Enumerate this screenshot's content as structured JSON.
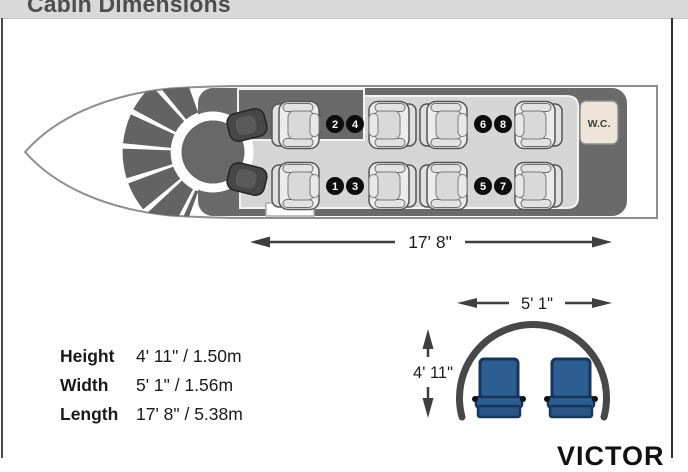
{
  "header": {
    "title": "Cabin Dimensions"
  },
  "plan": {
    "wc_label": "W.C.",
    "length_label": "17' 8\"",
    "top_numbers": [
      "2",
      "4",
      "6",
      "8"
    ],
    "bottom_numbers": [
      "1",
      "3",
      "5",
      "7"
    ]
  },
  "cross_section": {
    "width_label": "5' 1\"",
    "height_label": "4' 11\""
  },
  "specs": {
    "rows": [
      {
        "label": "Height",
        "value": "4' 11\" / 1.50m"
      },
      {
        "label": "Width",
        "value": "5' 1\" / 1.56m"
      },
      {
        "label": "Length",
        "value": "17' 8\" / 5.38m"
      }
    ]
  },
  "brand": {
    "name": "VICTOR"
  },
  "colors": {
    "header_bar": "#d9d9d9",
    "cabin_dark": "#6a6a6a",
    "floor_light": "#d6d6d6",
    "seat_plan_fill": "#ebebeb",
    "seat_number_badge": "#0d0d0d",
    "wc_beige": "#ece5d8",
    "seat_blue": "#2d5e92",
    "dimension_line": "#3f3f3f"
  }
}
